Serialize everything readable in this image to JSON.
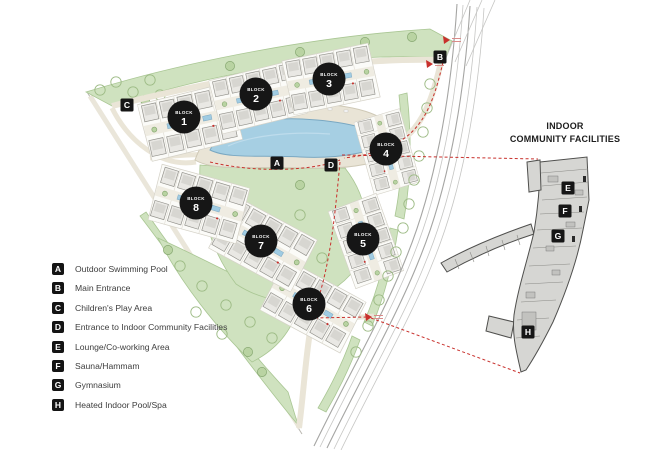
{
  "map": {
    "block_word": "BLOCK",
    "blocks": [
      {
        "num": "1"
      },
      {
        "num": "2"
      },
      {
        "num": "3"
      },
      {
        "num": "4"
      },
      {
        "num": "5"
      },
      {
        "num": "6"
      },
      {
        "num": "7"
      },
      {
        "num": "8"
      }
    ],
    "markers": [
      {
        "key": "A"
      },
      {
        "key": "B"
      },
      {
        "key": "C"
      },
      {
        "key": "D"
      }
    ]
  },
  "detail": {
    "title_line1": "INDOOR",
    "title_line2": "COMMUNITY FACILITIES",
    "markers": [
      {
        "key": "E"
      },
      {
        "key": "F"
      },
      {
        "key": "G"
      },
      {
        "key": "H"
      }
    ]
  },
  "legend": {
    "items": [
      {
        "key": "A",
        "label": "Outdoor Swimming Pool"
      },
      {
        "key": "B",
        "label": "Main Entrance"
      },
      {
        "key": "C",
        "label": "Children's Play Area"
      },
      {
        "key": "D",
        "label": "Entrance to Indoor Community Facilities"
      },
      {
        "key": "E",
        "label": "Lounge/Co-working Area"
      },
      {
        "key": "F",
        "label": "Sauna/Hammam"
      },
      {
        "key": "G",
        "label": "Gymnasium"
      },
      {
        "key": "H",
        "label": "Heated Indoor Pool/Spa"
      }
    ]
  },
  "colors": {
    "site_green": "#cfe2bf",
    "path_beige": "#eae5d7",
    "pool_blue": "#a6cfe3",
    "accent_red": "#c8302c",
    "marker_black": "#161616",
    "detail_gray": "#d6d6d3"
  }
}
